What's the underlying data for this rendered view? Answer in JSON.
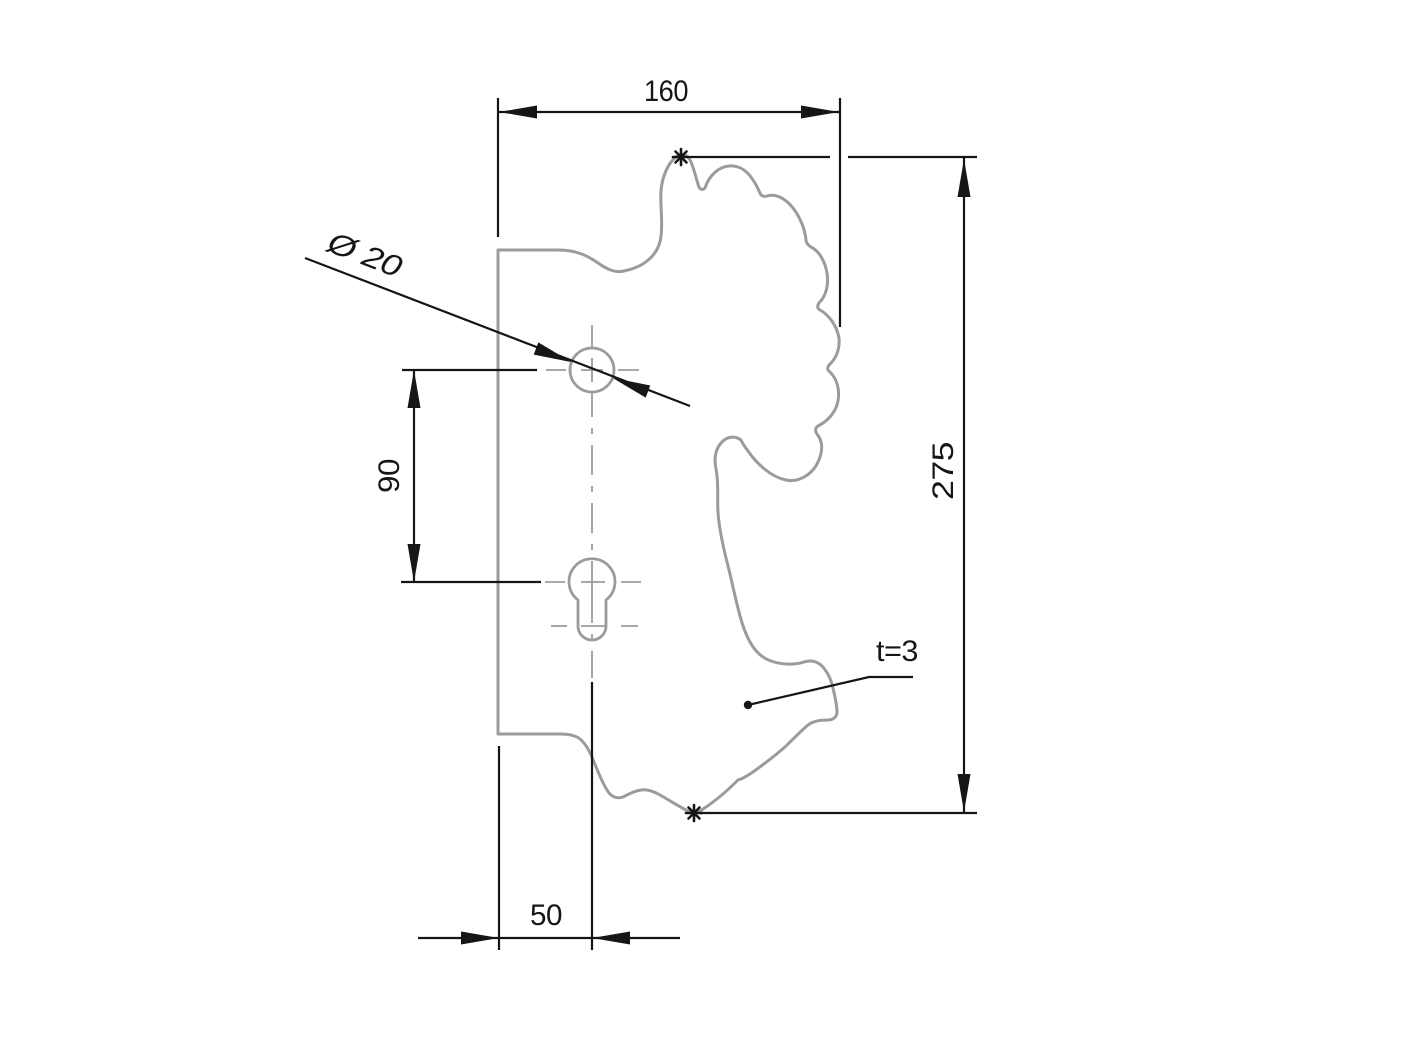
{
  "colors": {
    "background": "#ffffff",
    "outline": "#9b9b9b",
    "ink": "#161616"
  },
  "dimensions": {
    "top_width": "160",
    "overall_height": "275",
    "hole_spacing": "90",
    "edge_to_center": "50",
    "hole_diameter": "Ø 20",
    "thickness": "t=3"
  },
  "markers": {
    "reference_symbol": "*"
  }
}
